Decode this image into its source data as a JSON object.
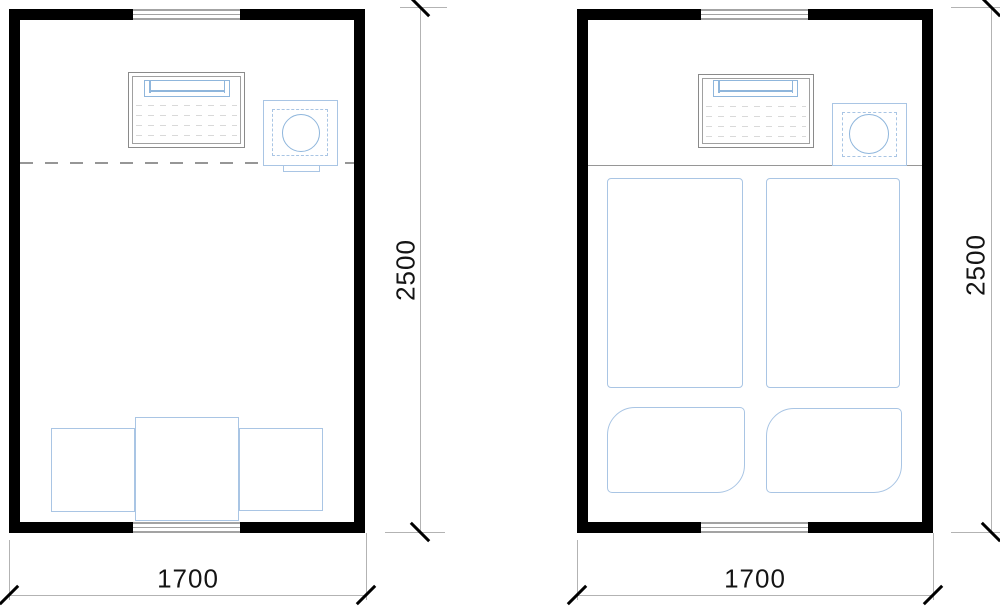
{
  "drawing": {
    "type": "floor-plan-comparison",
    "colors": {
      "walls": "#000000",
      "furniture_outline_blue": "#a9c5e4",
      "furniture_accent_blue": "#8fb6dc",
      "desk_outline_gray": "#8a8a8a",
      "dimension_line_gray": "#b3b3b3",
      "dimension_text": "#141414",
      "divider_gray": "#969696",
      "window_gray": "#a3a3a3"
    },
    "plans": [
      {
        "id": "plan-left",
        "width_label": "1700",
        "height_label": "2500",
        "divider_style": "dashed",
        "furniture": [
          "desk",
          "office-chair",
          "low-table",
          "floor-seat",
          "floor-seat"
        ],
        "openings": [
          "window-top",
          "window-bottom"
        ]
      },
      {
        "id": "plan-right",
        "width_label": "1700",
        "height_label": "2500",
        "divider_style": "solid",
        "furniture": [
          "desk",
          "office-chair",
          "mattress",
          "mattress",
          "floor-cushion",
          "floor-cushion"
        ],
        "openings": [
          "window-top",
          "window-bottom"
        ]
      }
    ]
  }
}
